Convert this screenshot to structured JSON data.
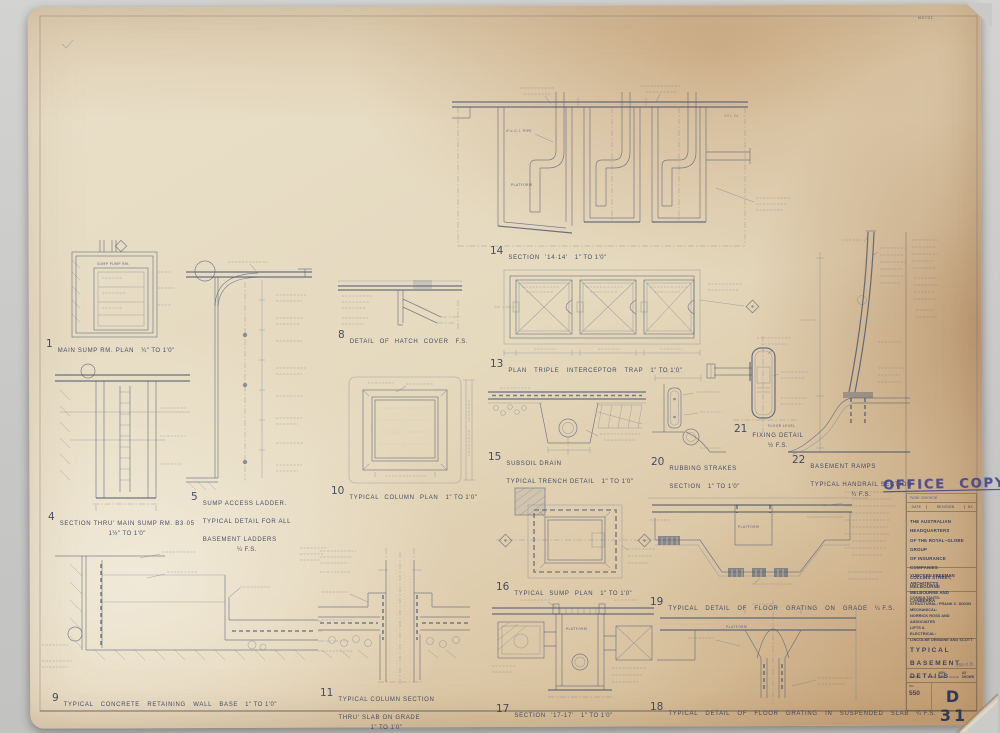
{
  "sheet": {
    "stamp": "OFFICE COPY",
    "corner_mark": "N0701"
  },
  "colors": {
    "paper": "#e5d9be",
    "ink": "#4f5b74",
    "stamp_blue": "#3c3f8f"
  },
  "title_block": {
    "revision_entry": "Note  General",
    "revision_header": {
      "date": "DATE",
      "revision": "REVISION",
      "by": "BY"
    },
    "project_lines": [
      "THE AUSTRALIAN HEADQUARTERS",
      "OF THE ROYAL–GLOBE GROUP",
      "OF INSURANCE COMPANIES",
      "COLLINS STREET, MELBOURNE"
    ],
    "architects_lines": [
      "YUNCKEN FREEMAN ARCHITECTS",
      "MELBOURNE AND CANBERRA"
    ],
    "consultants_lines": [
      "CONSULTANTS:",
      "STRUCTURAL: FRANK C. DIXON",
      "MECHANICAL:",
      "NORRICK ROSS AND ASSOCIATES",
      "LIFTS &",
      "ELECTRICAL:",
      "LINCOLNE DEMAINE AND SCOTT"
    ],
    "drawing_title": "TYPICAL BASEMENT\nDETAILS",
    "drawn_label": "DRAWN",
    "date_label": "DATE",
    "scale_label": "SCALE",
    "date_value": "NOV. 1962",
    "scale_value": "AS SHOWN",
    "handwritten_note": "956 K.B.",
    "no_label": "NO.",
    "job_number": "550",
    "drawing_number": "D 31"
  },
  "annotations": {
    "platform": "PLATFORM",
    "sump_pump_rm": "SUMP PUMP RM.",
    "ci_pipe": "4\"⌀ C.I. PIPE",
    "floor_level": "FLOOR LEVEL",
    "vol_note": "VOL 34"
  },
  "details": [
    {
      "num": "1",
      "label": "MAIN SUMP RM.  PLAN",
      "scale": "¼\" TO 1'0\""
    },
    {
      "num": "4",
      "label": "SECTION THRU' MAIN SUMP RM.  B3·05",
      "scale": "1½\" TO 1'0\""
    },
    {
      "num": "5",
      "label": "SUMP ACCESS LADDER.\nTYPICAL DETAIL FOR ALL\nBASEMENT LADDERS",
      "scale": "¼ F.S."
    },
    {
      "num": "8",
      "label": "DETAIL OF HATCH COVER",
      "scale": "F.S."
    },
    {
      "num": "9",
      "label": "TYPICAL CONCRETE RETAINING WALL BASE",
      "scale": "1\" TO 1'0\""
    },
    {
      "num": "10",
      "label": "TYPICAL COLUMN PLAN",
      "scale": "1\" TO 1'0\""
    },
    {
      "num": "11",
      "label": "TYPICAL COLUMN SECTION\nTHRU' SLAB ON GRADE",
      "scale": "1\" TO 1'0\""
    },
    {
      "num": "13",
      "label": "PLAN TRIPLE INTERCEPTOR TRAP",
      "scale": "1\" TO 1'0\""
    },
    {
      "num": "14",
      "label": "SECTION '14·14'",
      "scale": "1\" TO 1'0\""
    },
    {
      "num": "15",
      "label": "SUBSOIL DRAIN\nTYPICAL TRENCH DETAIL",
      "scale": "1\" TO 1'0\""
    },
    {
      "num": "16",
      "label": "TYPICAL SUMP  PLAN",
      "scale": "1\" TO 1'0\""
    },
    {
      "num": "17",
      "label": "SECTION '17-17'",
      "scale": "1\" TO 1'0\""
    },
    {
      "num": "18",
      "label": "TYPICAL DETAIL OF FLOOR GRATING IN SUSPENDED SLAB",
      "scale": "¼ F.S."
    },
    {
      "num": "19",
      "label": "TYPICAL DETAIL OF FLOOR GRATING ON GRADE",
      "scale": "¼ F.S."
    },
    {
      "num": "20",
      "label": "RUBBING STRAKES\nSECTION",
      "scale": "1\" TO 1'0\""
    },
    {
      "num": "21",
      "label": "FIXING DETAIL",
      "scale": "½ F.S."
    },
    {
      "num": "22",
      "label": "BASEMENT RAMPS\nTYPICAL HANDRAIL SECTION",
      "scale": "¼ F.S."
    }
  ]
}
